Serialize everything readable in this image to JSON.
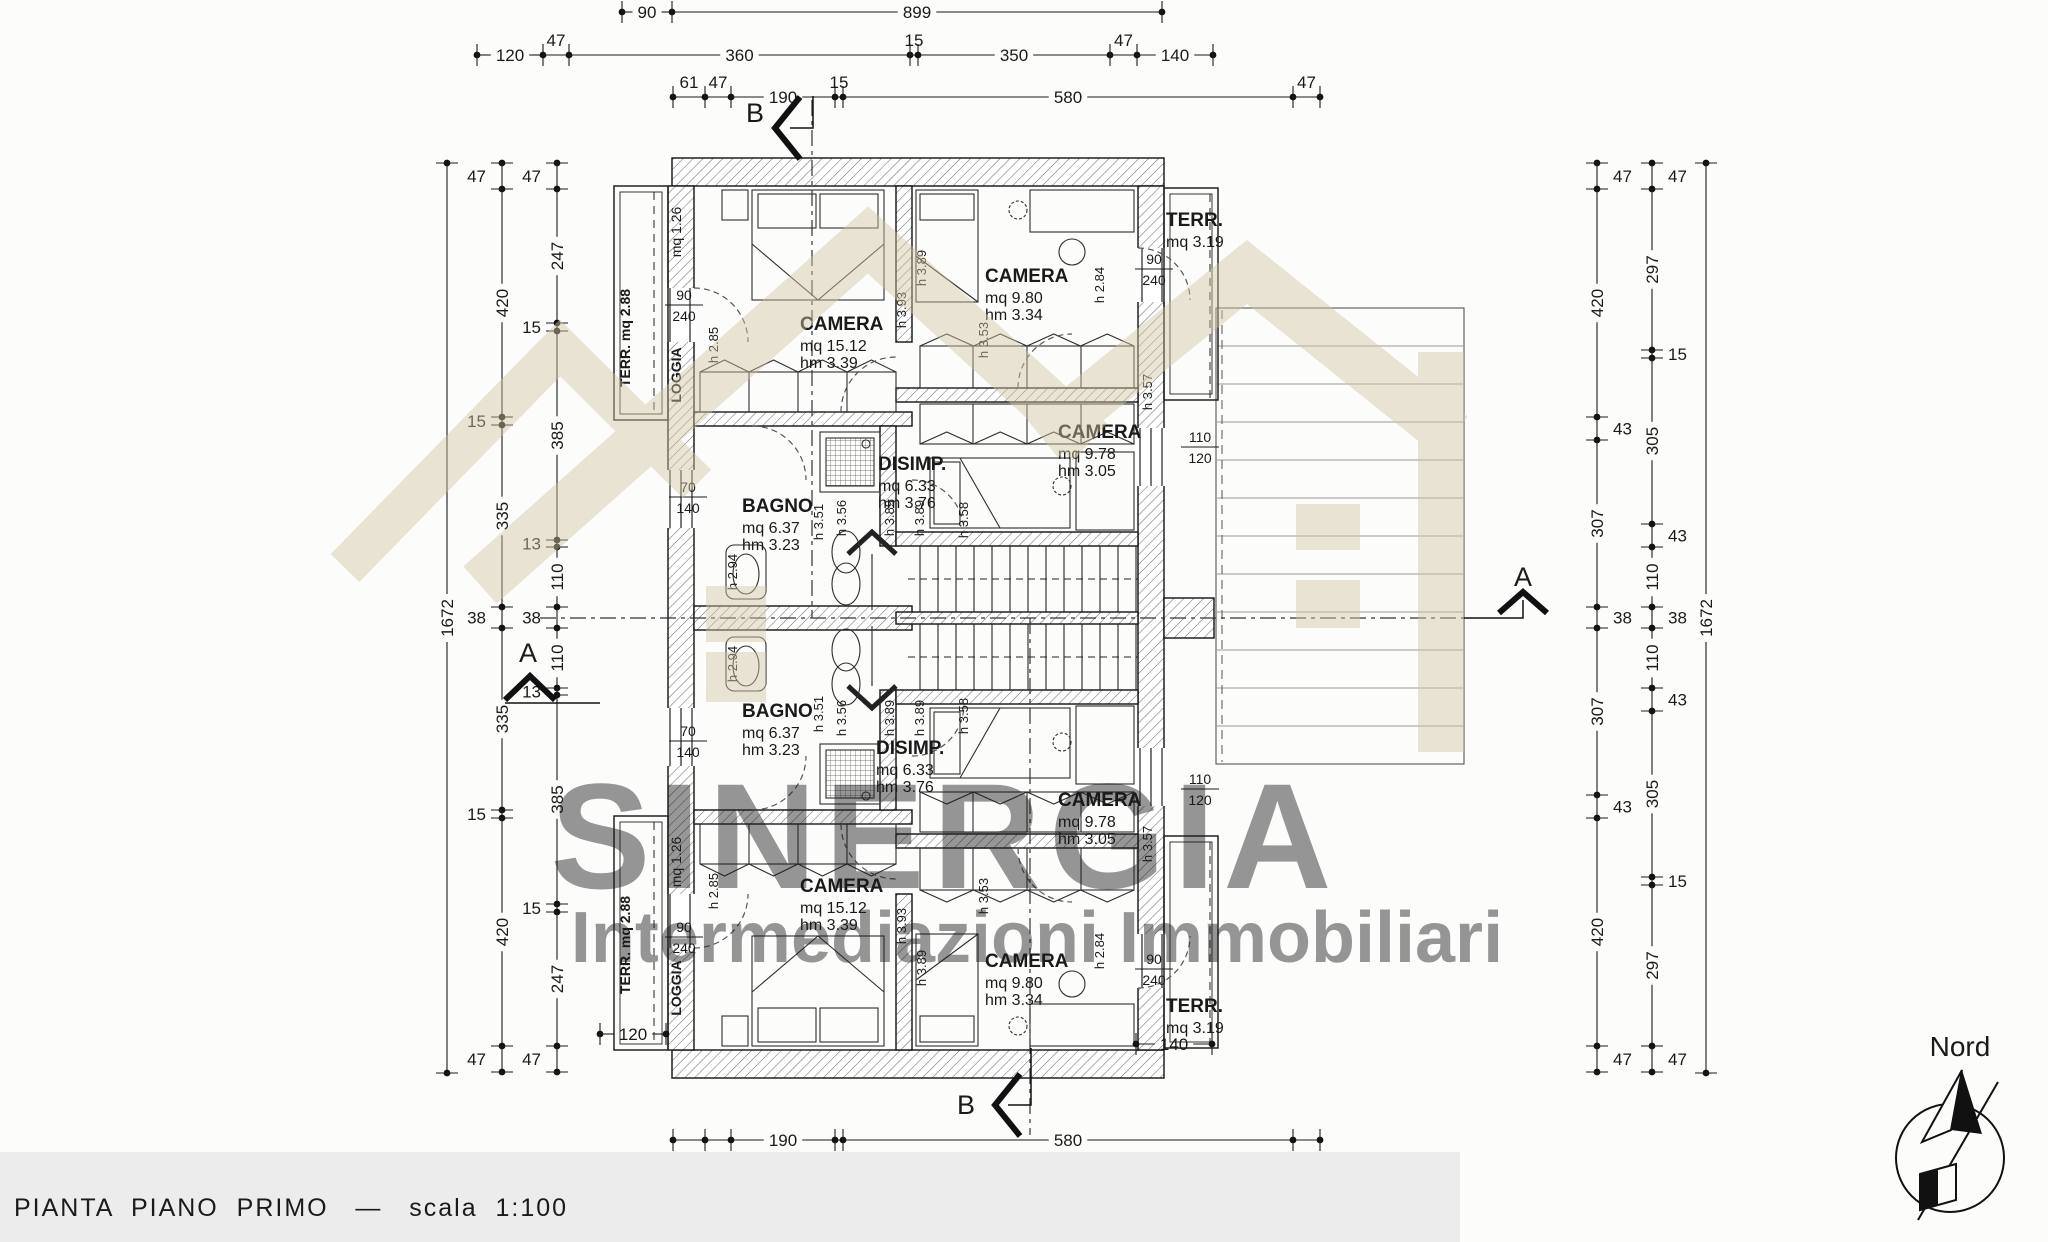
{
  "meta": {
    "title": "PIANTA  PIANO  PRIMO   —   scala  1:100"
  },
  "north": {
    "label": "Nord"
  },
  "watermark": {
    "line1": "SINERGIA",
    "line2": "Intermediazioni Immobiliari",
    "color": "#d2c5a2"
  },
  "sections": {
    "a": "A",
    "b": "B"
  },
  "rooms": [
    {
      "name": "CAMERA",
      "mq": "mq  15.12",
      "hm": "hm  3.39",
      "x": 800,
      "y": 330
    },
    {
      "name": "CAMERA",
      "mq": "mq  9.80",
      "hm": "hm  3.34",
      "x": 985,
      "y": 282
    },
    {
      "name": "TERR.",
      "mq": "mq 3.19",
      "x": 1166,
      "y": 226
    },
    {
      "name": "BAGNO",
      "mq": "mq  6.37",
      "hm": "hm  3.23",
      "x": 742,
      "y": 512
    },
    {
      "name": "DISIMP.",
      "mq": "mq  6.33",
      "hm": "hm  3.76",
      "x": 878,
      "y": 470
    },
    {
      "name": "CAMERA",
      "mq": "mq  9.78",
      "hm": "hm  3.05",
      "x": 1058,
      "y": 438
    },
    {
      "name": "BAGNO",
      "mq": "mq  6.37",
      "hm": "hm  3.23",
      "x": 742,
      "y": 717
    },
    {
      "name": "DISIMP.",
      "mq": "mq  6.33",
      "hm": "hm  3.76",
      "x": 876,
      "y": 754
    },
    {
      "name": "CAMERA",
      "mq": "mq  9.78",
      "hm": "hm  3.05",
      "x": 1058,
      "y": 806
    },
    {
      "name": "CAMERA",
      "mq": "mq  15.12",
      "hm": "hm  3.39",
      "x": 800,
      "y": 892
    },
    {
      "name": "CAMERA",
      "mq": "mq  9.80",
      "hm": "hm  3.34",
      "x": 985,
      "y": 967
    },
    {
      "name": "TERR.",
      "mq": "mq 3.19",
      "x": 1166,
      "y": 1012
    }
  ],
  "vlabels": [
    {
      "text": "TERR. mq 2.88",
      "x": 630,
      "y": 338,
      "bold": true
    },
    {
      "text": "mq 1.26",
      "x": 681,
      "y": 232,
      "bold": false
    },
    {
      "text": "LOGGIA",
      "x": 681,
      "y": 375,
      "bold": true
    },
    {
      "text": "TERR. mq 2.88",
      "x": 630,
      "y": 945,
      "bold": true
    },
    {
      "text": "mq 1.26",
      "x": 681,
      "y": 862,
      "bold": false
    },
    {
      "text": "LOGGIA",
      "x": 681,
      "y": 988,
      "bold": true
    }
  ],
  "door_dims": [
    {
      "a": "90",
      "b": "240",
      "x": 684,
      "y": 300
    },
    {
      "a": "90",
      "b": "240",
      "x": 1154,
      "y": 264
    },
    {
      "a": "70",
      "b": "140",
      "x": 688,
      "y": 492
    },
    {
      "a": "110",
      "b": "120",
      "x": 1200,
      "y": 442
    },
    {
      "a": "70",
      "b": "140",
      "x": 688,
      "y": 736
    },
    {
      "a": "90",
      "b": "240",
      "x": 684,
      "y": 932
    },
    {
      "a": "90",
      "b": "240",
      "x": 1154,
      "y": 964
    },
    {
      "a": "110",
      "b": "120",
      "x": 1200,
      "y": 784
    }
  ],
  "h_labels": [
    {
      "t": "h 2.85",
      "x": 718,
      "y": 345
    },
    {
      "t": "h 3.93",
      "x": 906,
      "y": 310
    },
    {
      "t": "h 3.89",
      "x": 926,
      "y": 268
    },
    {
      "t": "h 2.84",
      "x": 1104,
      "y": 285
    },
    {
      "t": "h 3.53",
      "x": 988,
      "y": 340
    },
    {
      "t": "h 3.57",
      "x": 1152,
      "y": 392
    },
    {
      "t": "h 3.51",
      "x": 823,
      "y": 522
    },
    {
      "t": "h 3.56",
      "x": 846,
      "y": 518
    },
    {
      "t": "h 3.89",
      "x": 894,
      "y": 518
    },
    {
      "t": "h 3.89",
      "x": 924,
      "y": 518
    },
    {
      "t": "h 2.94",
      "x": 737,
      "y": 572
    },
    {
      "t": "h 3.58",
      "x": 968,
      "y": 520
    },
    {
      "t": "h 2.85",
      "x": 718,
      "y": 891
    },
    {
      "t": "h 3.93",
      "x": 906,
      "y": 926
    },
    {
      "t": "h 3.89",
      "x": 926,
      "y": 968
    },
    {
      "t": "h 2.84",
      "x": 1104,
      "y": 951
    },
    {
      "t": "h 3.53",
      "x": 988,
      "y": 896
    },
    {
      "t": "h 3.57",
      "x": 1152,
      "y": 844
    },
    {
      "t": "h 3.51",
      "x": 823,
      "y": 714
    },
    {
      "t": "h 3.56",
      "x": 846,
      "y": 718
    },
    {
      "t": "h 3.89",
      "x": 894,
      "y": 718
    },
    {
      "t": "h 3.89",
      "x": 924,
      "y": 718
    },
    {
      "t": "h 2.94",
      "x": 737,
      "y": 664
    },
    {
      "t": "h 3.58",
      "x": 968,
      "y": 716
    }
  ],
  "mini_dims": [
    {
      "label": "120",
      "x1": 600,
      "x2": 666,
      "y": 1034
    },
    {
      "label": "140",
      "x1": 1136,
      "x2": 1212,
      "y": 1044
    }
  ],
  "chains": {
    "h": [
      {
        "y": 12,
        "start": 622,
        "small": "above",
        "segs": [
          [
            "90",
            50
          ],
          [
            "899",
            490
          ]
        ]
      },
      {
        "y": 55,
        "start": 477,
        "small": "above",
        "segs": [
          [
            "120",
            66
          ],
          [
            "47",
            26
          ],
          [
            "360",
            341
          ],
          [
            "15",
            8
          ],
          [
            "350",
            192
          ],
          [
            "47",
            27
          ],
          [
            "140",
            76
          ]
        ]
      },
      {
        "y": 97,
        "start": 673,
        "small": "above",
        "segs": [
          [
            "61",
            32
          ],
          [
            "47",
            26
          ],
          [
            "190",
            104
          ],
          [
            "15",
            8
          ],
          [
            "580",
            450
          ],
          [
            "47",
            27
          ]
        ]
      },
      {
        "y": 1140,
        "start": 673,
        "small": "below",
        "segs": [
          [
            "61",
            32
          ],
          [
            "47",
            26
          ],
          [
            "190",
            104
          ],
          [
            "15",
            8
          ],
          [
            "580",
            450
          ],
          [
            "47",
            27
          ]
        ]
      },
      {
        "y": 1180,
        "start": 595,
        "small": "below",
        "segs": [
          [
            "120",
            66
          ],
          [
            "47",
            26
          ],
          [
            "360",
            198
          ],
          [
            "15",
            8
          ],
          [
            "105",
            57
          ],
          [
            "15",
            8
          ],
          [
            "320",
            176
          ],
          [
            "47",
            26
          ]
        ]
      },
      {
        "y": 1220,
        "start": 672,
        "small": "below",
        "segs": [
          [
            "899",
            573
          ]
        ]
      }
    ],
    "v": [
      {
        "x": 447,
        "start": 163,
        "side": "left",
        "segs": [
          [
            "1672",
            910
          ]
        ]
      },
      {
        "x": 502,
        "start": 163,
        "side": "left",
        "segs": [
          [
            "47",
            26
          ],
          [
            "420",
            228
          ],
          [
            "15",
            8
          ],
          [
            "335",
            182
          ],
          [
            "38",
            21
          ],
          [
            "335",
            182
          ],
          [
            "15",
            8
          ],
          [
            "420",
            228
          ],
          [
            "47",
            26
          ]
        ]
      },
      {
        "x": 557,
        "start": 163,
        "side": "left",
        "segs": [
          [
            "47",
            26
          ],
          [
            "247",
            134
          ],
          [
            "15",
            8
          ],
          [
            "385",
            209
          ],
          [
            "13",
            7
          ],
          [
            "110",
            60
          ],
          [
            "38",
            21
          ],
          [
            "110",
            60
          ],
          [
            "13",
            7
          ],
          [
            "385",
            209
          ],
          [
            "15",
            8
          ],
          [
            "247",
            134
          ],
          [
            "47",
            26
          ]
        ]
      },
      {
        "x": 1597,
        "start": 163,
        "side": "right",
        "segs": [
          [
            "47",
            26
          ],
          [
            "420",
            228
          ],
          [
            "43",
            23
          ],
          [
            "307",
            167
          ],
          [
            "38",
            21
          ],
          [
            "307",
            167
          ],
          [
            "43",
            23
          ],
          [
            "420",
            228
          ],
          [
            "47",
            26
          ]
        ]
      },
      {
        "x": 1652,
        "start": 163,
        "side": "right",
        "segs": [
          [
            "47",
            26
          ],
          [
            "297",
            161
          ],
          [
            "15",
            8
          ],
          [
            "305",
            166
          ],
          [
            "43",
            23
          ],
          [
            "110",
            60
          ],
          [
            "38",
            21
          ],
          [
            "110",
            60
          ],
          [
            "43",
            23
          ],
          [
            "305",
            166
          ],
          [
            "15",
            8
          ],
          [
            "297",
            161
          ],
          [
            "47",
            26
          ]
        ]
      },
      {
        "x": 1706,
        "start": 163,
        "side": "right",
        "segs": [
          [
            "1672",
            910
          ]
        ]
      }
    ]
  }
}
